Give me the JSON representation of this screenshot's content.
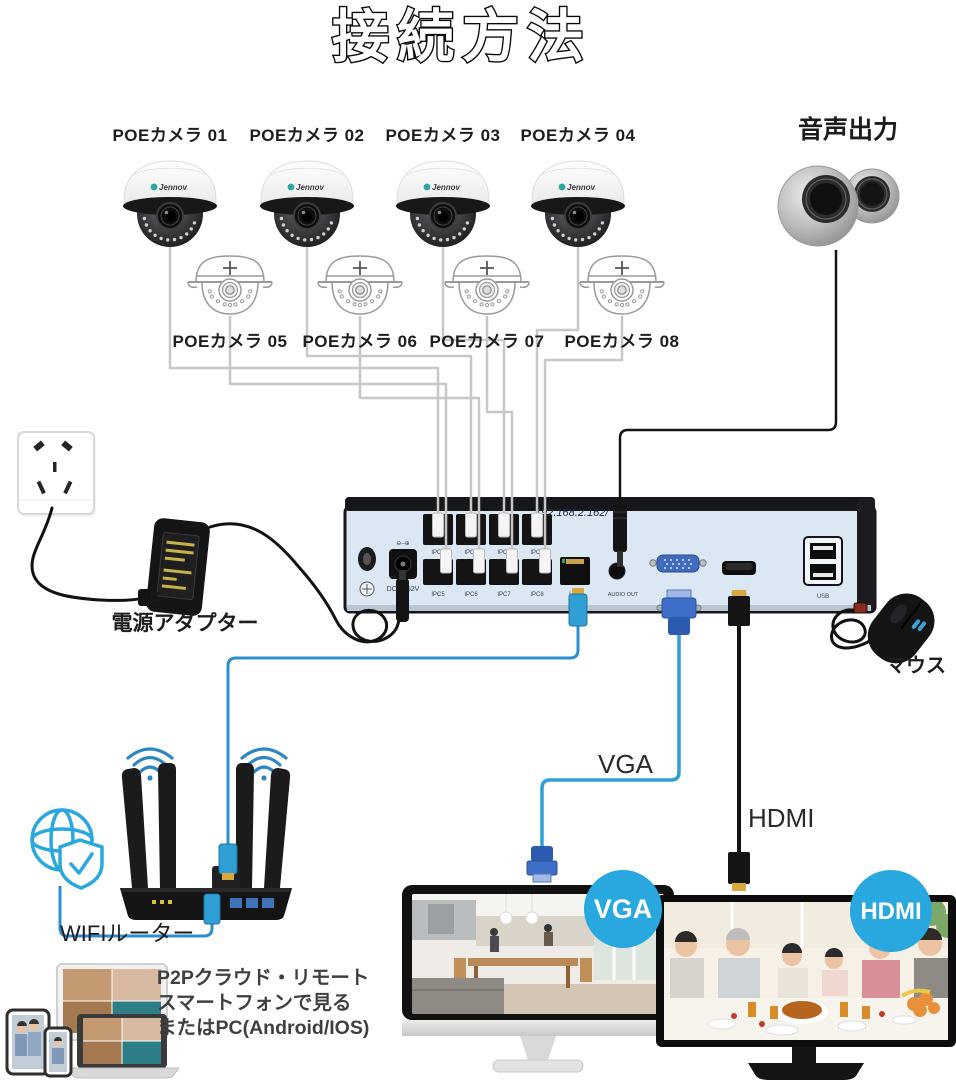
{
  "title": "接続方法",
  "colors": {
    "accent_blue": "#29a7df",
    "cable_blue": "#2f9fd6",
    "cable_gray": "#c7c7c7",
    "nvr_face": "#dbe8f4",
    "black": "#141414"
  },
  "cameras": {
    "brand": "Jennov",
    "row1": [
      "POEカメラ 01",
      "POEカメラ 02",
      "POEカメラ 03",
      "POEカメラ 04"
    ],
    "row2": [
      "POEカメラ 05",
      "POEカメラ 06",
      "POEカメラ 07",
      "POEカメラ 08"
    ]
  },
  "audio_output": {
    "label": "音声出力"
  },
  "power": {
    "adapter_label": "電源アダプター"
  },
  "nvr": {
    "ip_text": "192.168.2.162/",
    "dc_label": "DC48-52V",
    "dc_polarity": "⊖–⊕",
    "poe_ports": [
      "IPC1",
      "IPC2",
      "IPC3",
      "IPC4",
      "IPC5",
      "IPC6",
      "IPC7",
      "IPC8"
    ],
    "lan_label": "LAN",
    "audio_out_label": "AUDIO OUT",
    "vga_label": "VGA",
    "hdmi_label": "HDMI",
    "usb_label": "USB"
  },
  "mouse_label": "マウス",
  "router_label": "WIFIルーター",
  "remote": {
    "line1": "P2Pクラウド・リモート",
    "line2": "スマートフォンで見る",
    "line3": "またはPC(Android/IOS)"
  },
  "vga": {
    "cable_label": "VGA",
    "badge": "VGA"
  },
  "hdmi": {
    "cable_label": "HDMI",
    "badge": "HDMI"
  }
}
